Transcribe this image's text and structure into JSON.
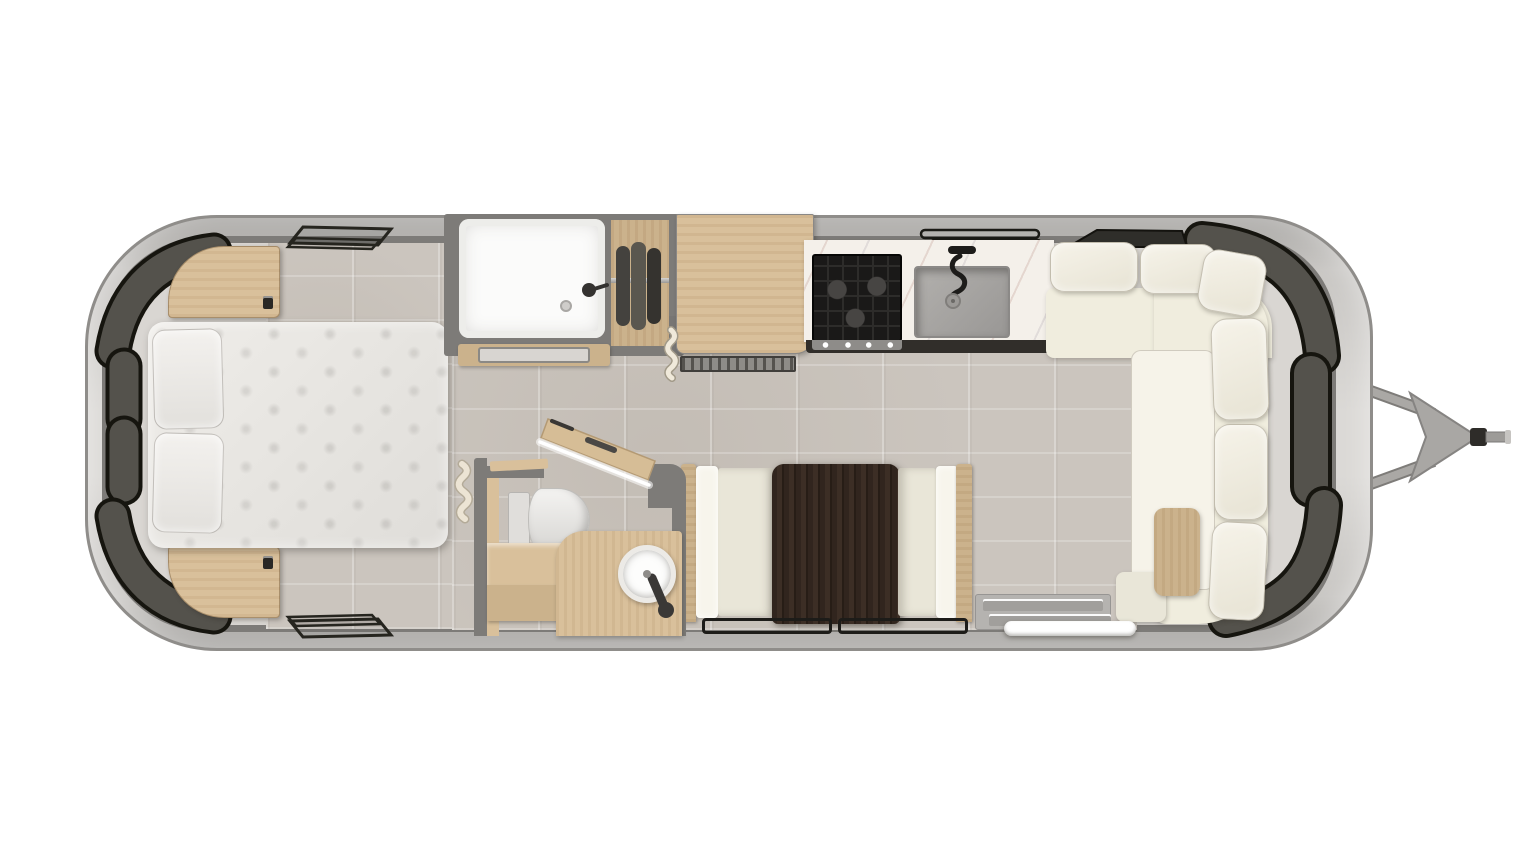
{
  "title": "Travel trailer floor plan — overhead rendering",
  "layout": {
    "canvas_width": 1536,
    "canvas_height": 864
  },
  "colors": {
    "page_bg": "#ffffff",
    "shell_light": "#dbd9d6",
    "shell_mid": "#c8c6c3",
    "shell_dark": "#a3a19e",
    "shell_edge": "#8f8d8a",
    "wall": "#7d7b78",
    "interior": "#d9d6d2",
    "tile": "#cbc5be",
    "tile_grout": "#ded9d3",
    "window_fill": "#54524c",
    "window_outline": "#16150f",
    "wood": "#d9c09b",
    "wood_deep": "#cbb28c",
    "wood_pale": "#e2cda8",
    "espresso": "#2e2219",
    "sofa_cream": "#f0edde",
    "sofa_cushion": "#f6f3e9",
    "sofa_seat": "#e9e6d8",
    "mattress": "#e7e5e1",
    "pillow": "#f1efec",
    "white": "#fbfbfa",
    "marble": "#f4f0ea",
    "steel": "#a5a3a0",
    "steel_dark": "#8e8c89",
    "appliance_black": "#1a1918",
    "sink_gray": "#a8a6a3",
    "led_white": "#ffffff",
    "mat_gray": "#d8d5d1",
    "towel_cream": "#ece4d4"
  },
  "features": {
    "bedroom": [
      "queen-bed",
      "pillow-top",
      "pillow-bottom",
      "nightstand-top",
      "nightstand-bottom",
      "tv",
      "roof-vent-top",
      "roof-vent-bottom",
      "curved-window-bands"
    ],
    "front_bath": [
      "shower",
      "shower-head",
      "shower-drain",
      "shower-mat",
      "wardrobe",
      "hanging-clothes",
      "towel-hooks"
    ],
    "kitchen": [
      "refrigerator-cabinet",
      "louver-vent",
      "three-burner-cooktop",
      "sink",
      "coiled-faucet",
      "marble-counter",
      "window-rails"
    ],
    "rear_bathroom": [
      "toilet",
      "round-vessel-sink",
      "faucet",
      "vanity",
      "bench",
      "open-door-with-led-edge"
    ],
    "dinette": [
      "espresso-table",
      "bench-left",
      "bench-right",
      "floor-window-outlines"
    ],
    "lounge": [
      "l-shaped-sofa",
      "back-pillows",
      "chaise-cushion",
      "ottoman",
      "wood-lap-table",
      "entry-step",
      "step-threshold"
    ],
    "exterior": [
      "a-frame-hitch-bars",
      "hitch-triangle",
      "coupler",
      "jack-rod"
    ]
  }
}
